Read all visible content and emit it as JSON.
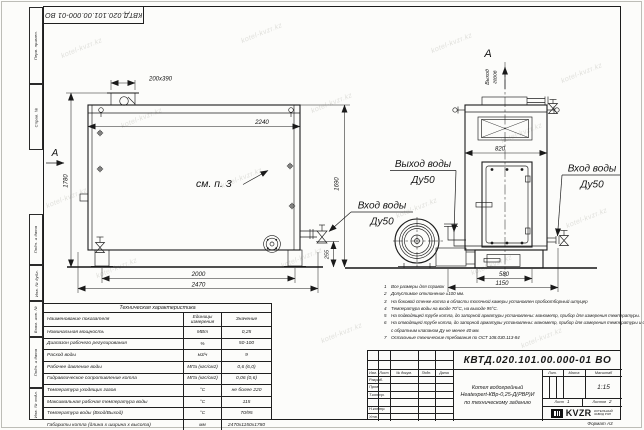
{
  "sheet": {
    "designation_stamp": "КВТД.020.101.00.000-01 ВО",
    "format_label": "Формат А3",
    "margin_labels": [
      "Перв. примен.",
      "Справ. №",
      "Подп. и дата",
      "Инв. № дубл.",
      "Взам. инв. №",
      "Подп. и дата",
      "Инв. № подл."
    ],
    "watermark": "kotel-kvzr.kz"
  },
  "dims": {
    "flue_stub": "200х390",
    "top_width": "2240",
    "height_total": "1780",
    "height_body": "1690",
    "base_offset": "255",
    "legs_span": "2000",
    "length_total": "2470",
    "front_width": "820",
    "front_base": "580",
    "front_total": "1150"
  },
  "labels": {
    "view_a": "А",
    "flue_line1": "Выход",
    "flue_line2": "газов",
    "water_out": "Выход воды",
    "water_in": "Вход воды",
    "dn50": "Ду50",
    "see_item": "см. п. 3"
  },
  "notes": {
    "items": [
      {
        "num": "1",
        "text": "Все размеры для справок"
      },
      {
        "num": "2",
        "text": "Допустимое отклонение ±100 мм."
      },
      {
        "num": "3",
        "text": "На боковой стенке котла в области топочной камеры установлен пробоотборный штуцер"
      },
      {
        "num": "4",
        "text": "Температура воды на входе 70°С, на выходе 95°С."
      },
      {
        "num": "5",
        "text": "На подводящей трубе котла, до запорной арматуры установлены: манометр, прибор для измерения температуры."
      },
      {
        "num": "6",
        "text": "На отводящей трубе котла, до запорной арматуры установлены: манометр, прибор для измерения температуры и обвод"
      },
      {
        "num": "",
        "text": "с обратным клапаном Ду не менее 40 мм."
      },
      {
        "num": "7",
        "text": "Остальные технические требования по ОСТ 108.030.113-84"
      }
    ]
  },
  "tech_table": {
    "title": "Техническая характеристика",
    "headers": [
      "Наименование показателя",
      "Единицы измерения",
      "Значение"
    ],
    "rows": [
      {
        "name": "Номинальная мощность",
        "unit": "МВт",
        "value": "0,25"
      },
      {
        "name": "Диапазон рабочего регулирования",
        "unit": "%",
        "value": "50-100"
      },
      {
        "name": "Расход воды",
        "unit": "м3/ч",
        "value": "9"
      },
      {
        "name": "Рабочее давление воды",
        "unit": "МПа (кгс/см2)",
        "value": "0,6 (6,0)"
      },
      {
        "name": "Гидравлическое сопротивление котла",
        "unit": "МПа (кгс/см2)",
        "value": "0,06 (0,6)"
      },
      {
        "name": "Температура уходящих газов",
        "unit": "°С",
        "value": "не более 220"
      },
      {
        "name": "Максимальная рабочая температура воды",
        "unit": "°С",
        "value": "115"
      },
      {
        "name": "Температура воды (Вход/Выход)",
        "unit": "°С",
        "value": "70/95"
      },
      {
        "name": "Габариты котла (длина х ширина х высота)",
        "unit": "мм",
        "value": "2470х1150х1780"
      }
    ]
  },
  "title_block": {
    "designation": "КВТД.020.101.00.000-01 ВО",
    "product_line1": "Котел водогрейный",
    "product_line2": "Heatexpert-КВр-0,25-Д(РВР)И",
    "product_line3": "по техническому заданию",
    "header_cols": [
      "Изм.",
      "Лист",
      "№ докум.",
      "Подп.",
      "Дата"
    ],
    "role_rows": [
      "Разраб.",
      "Пров.",
      "Т.контр.",
      "",
      "Н.контр.",
      "Утв."
    ],
    "lit_label": "Лит.",
    "mass_label": "Масса",
    "scale_label": "Масштаб",
    "scale_value": "1:15",
    "sheet_label": "Лист",
    "sheet_value": "1",
    "sheets_label": "Листов",
    "sheets_value": "2",
    "logo_text": "KVZR",
    "logo_sub1": "КОТЕЛЬНЫЙ",
    "logo_sub2": "ЗАВОД РЭП"
  }
}
